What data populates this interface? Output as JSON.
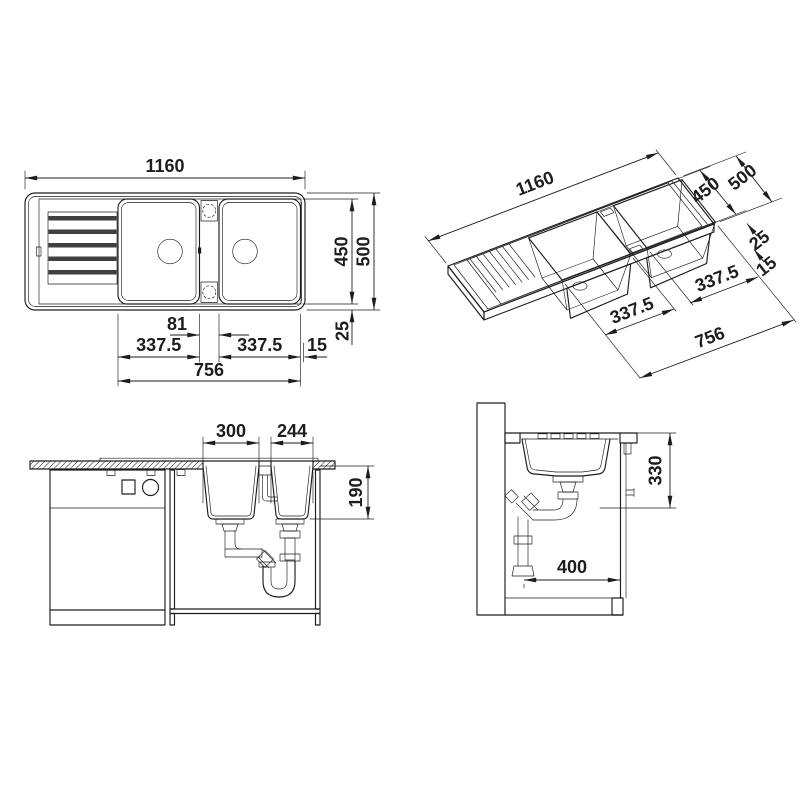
{
  "app": {
    "name": "Kitchen sink technical dimension drawing",
    "background": "#ffffff",
    "line_color": "#1d1d1b"
  },
  "views": {
    "top": {
      "label": "top-view",
      "dims": {
        "overall_length": "1160",
        "inner_width": "450",
        "overall_width": "500",
        "tap_strip_width": "81",
        "bowl1_width": "337.5",
        "bowl2_width": "337.5",
        "bowls_total": "756",
        "side_gap": "15",
        "rim_margin": "25"
      }
    },
    "perspective": {
      "label": "perspective-view",
      "dims": {
        "overall_length": "1160",
        "overall_width": "500",
        "inner_width": "450",
        "rim_margin": "25",
        "side_gap": "15",
        "bowl1_width": "337.5",
        "bowl2_width": "337.5",
        "bowls_total": "756"
      }
    },
    "front": {
      "label": "front-view",
      "dims": {
        "bowl1_top_width": "300",
        "bowl2_top_width": "244",
        "bowl_depth": "190"
      }
    },
    "section": {
      "label": "section-view",
      "dims": {
        "depth_below_worktop": "330",
        "wall_to_front": "400"
      }
    }
  }
}
